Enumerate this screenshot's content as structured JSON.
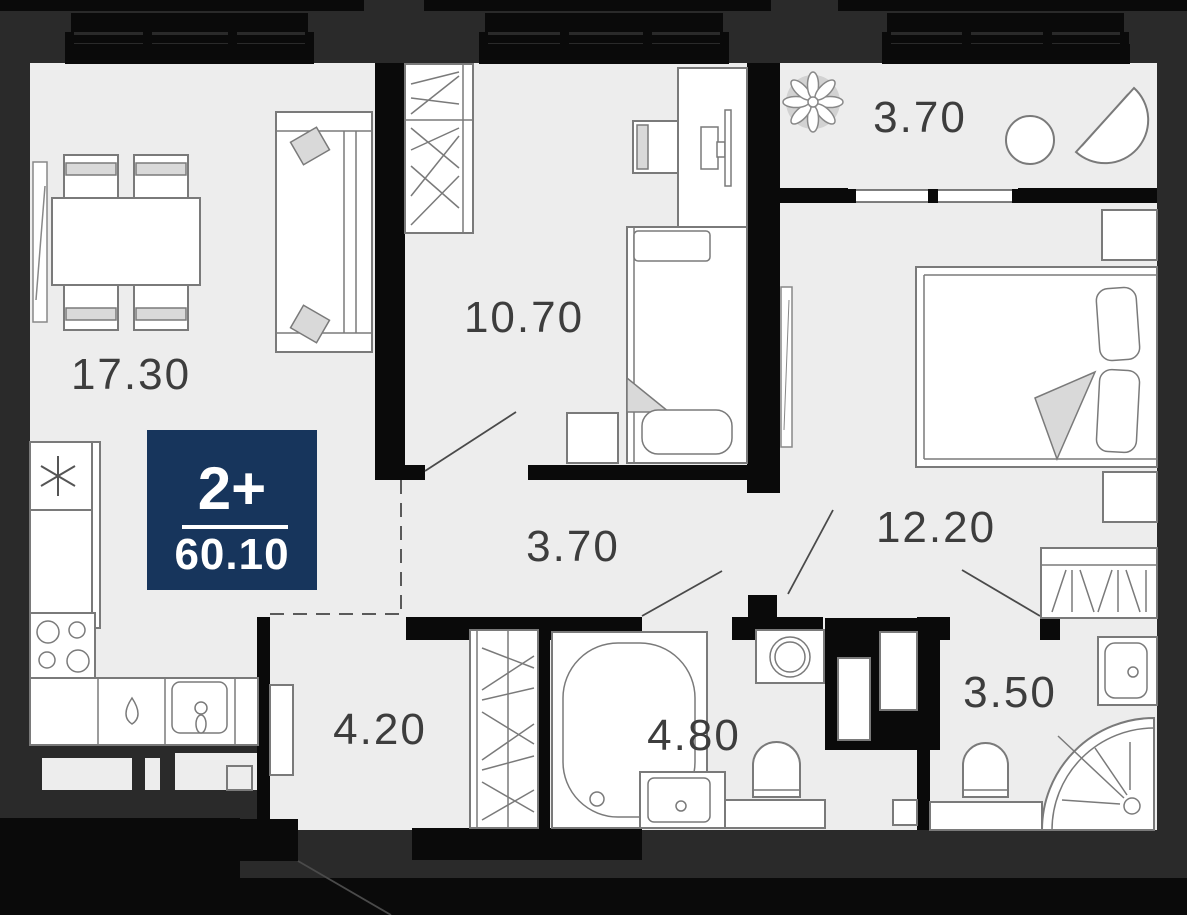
{
  "plan": {
    "badge": {
      "rooms_label": "2+",
      "total_area": "60.10"
    },
    "rooms": [
      {
        "name": "living-room",
        "area": "17.30"
      },
      {
        "name": "bedroom",
        "area": "10.70"
      },
      {
        "name": "balcony",
        "area": "3.70"
      },
      {
        "name": "master-bedroom",
        "area": "12.20"
      },
      {
        "name": "hallway",
        "area": "3.70"
      },
      {
        "name": "entry-hall",
        "area": "4.20"
      },
      {
        "name": "bathroom",
        "area": "4.80"
      },
      {
        "name": "shower-room",
        "area": "3.50"
      }
    ],
    "colors": {
      "background": "#2a2a2a",
      "floor": "#ededed",
      "walls": "#0a0a0a",
      "badge_background": "#17355c",
      "badge_text": "#ffffff",
      "label_text": "#3d3d3d",
      "furniture_outline": "#7a7a7a",
      "furniture_accent": "#d9d9d9"
    },
    "icons": {
      "fridge_symbol": "snowflake-icon",
      "balcony_plant": "plant-icon"
    }
  }
}
